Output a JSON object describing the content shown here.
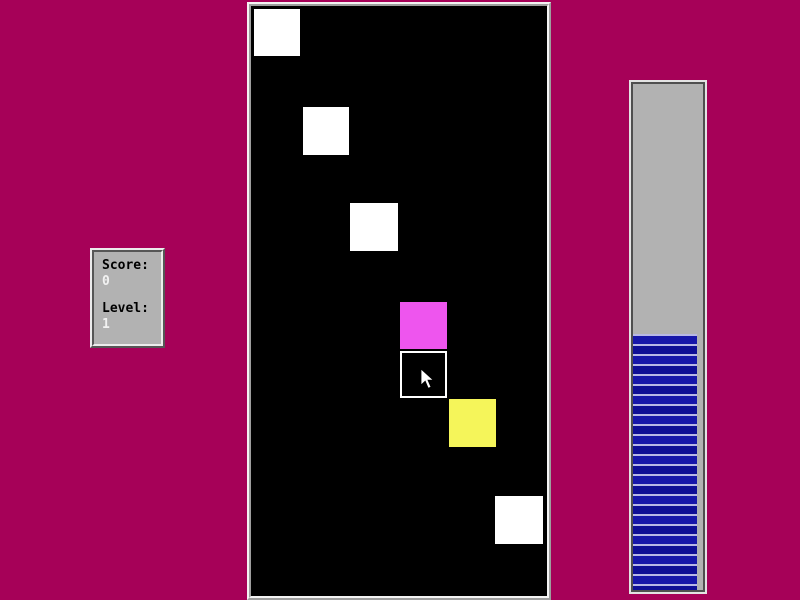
{
  "app": {
    "background_color": "#a60158"
  },
  "score_panel": {
    "score_label": "Score:",
    "score_value": "0",
    "level_label": "Level:",
    "level_value": "1",
    "panel_color": "#b2b2b2"
  },
  "play_field": {
    "background_color": "#000000",
    "squares": [
      {
        "x": 3,
        "y": 3,
        "w": 46,
        "h": 47,
        "color": "#ffffff",
        "outlined": false
      },
      {
        "x": 52,
        "y": 101,
        "w": 46,
        "h": 48,
        "color": "#ffffff",
        "outlined": false
      },
      {
        "x": 99,
        "y": 197,
        "w": 48,
        "h": 48,
        "color": "#ffffff",
        "outlined": false
      },
      {
        "x": 149,
        "y": 296,
        "w": 47,
        "h": 47,
        "color": "#ee55ee",
        "outlined": false
      },
      {
        "x": 149,
        "y": 345,
        "w": 47,
        "h": 47,
        "color": "#000000",
        "outlined": true
      },
      {
        "x": 198,
        "y": 393,
        "w": 47,
        "h": 48,
        "color": "#f5f55a",
        "outlined": false
      },
      {
        "x": 244,
        "y": 490,
        "w": 48,
        "h": 48,
        "color": "#ffffff",
        "outlined": false
      }
    ]
  },
  "progress_bar": {
    "fill_percent": 50.5,
    "trough_color": "#b2b2b2",
    "fill_color": "#1717a9",
    "fill_color_dark": "#0f0f95",
    "stripe_color": "#b8b8e6",
    "stripe_period_px": 10
  },
  "cursor": {
    "x": 420,
    "y": 368
  }
}
